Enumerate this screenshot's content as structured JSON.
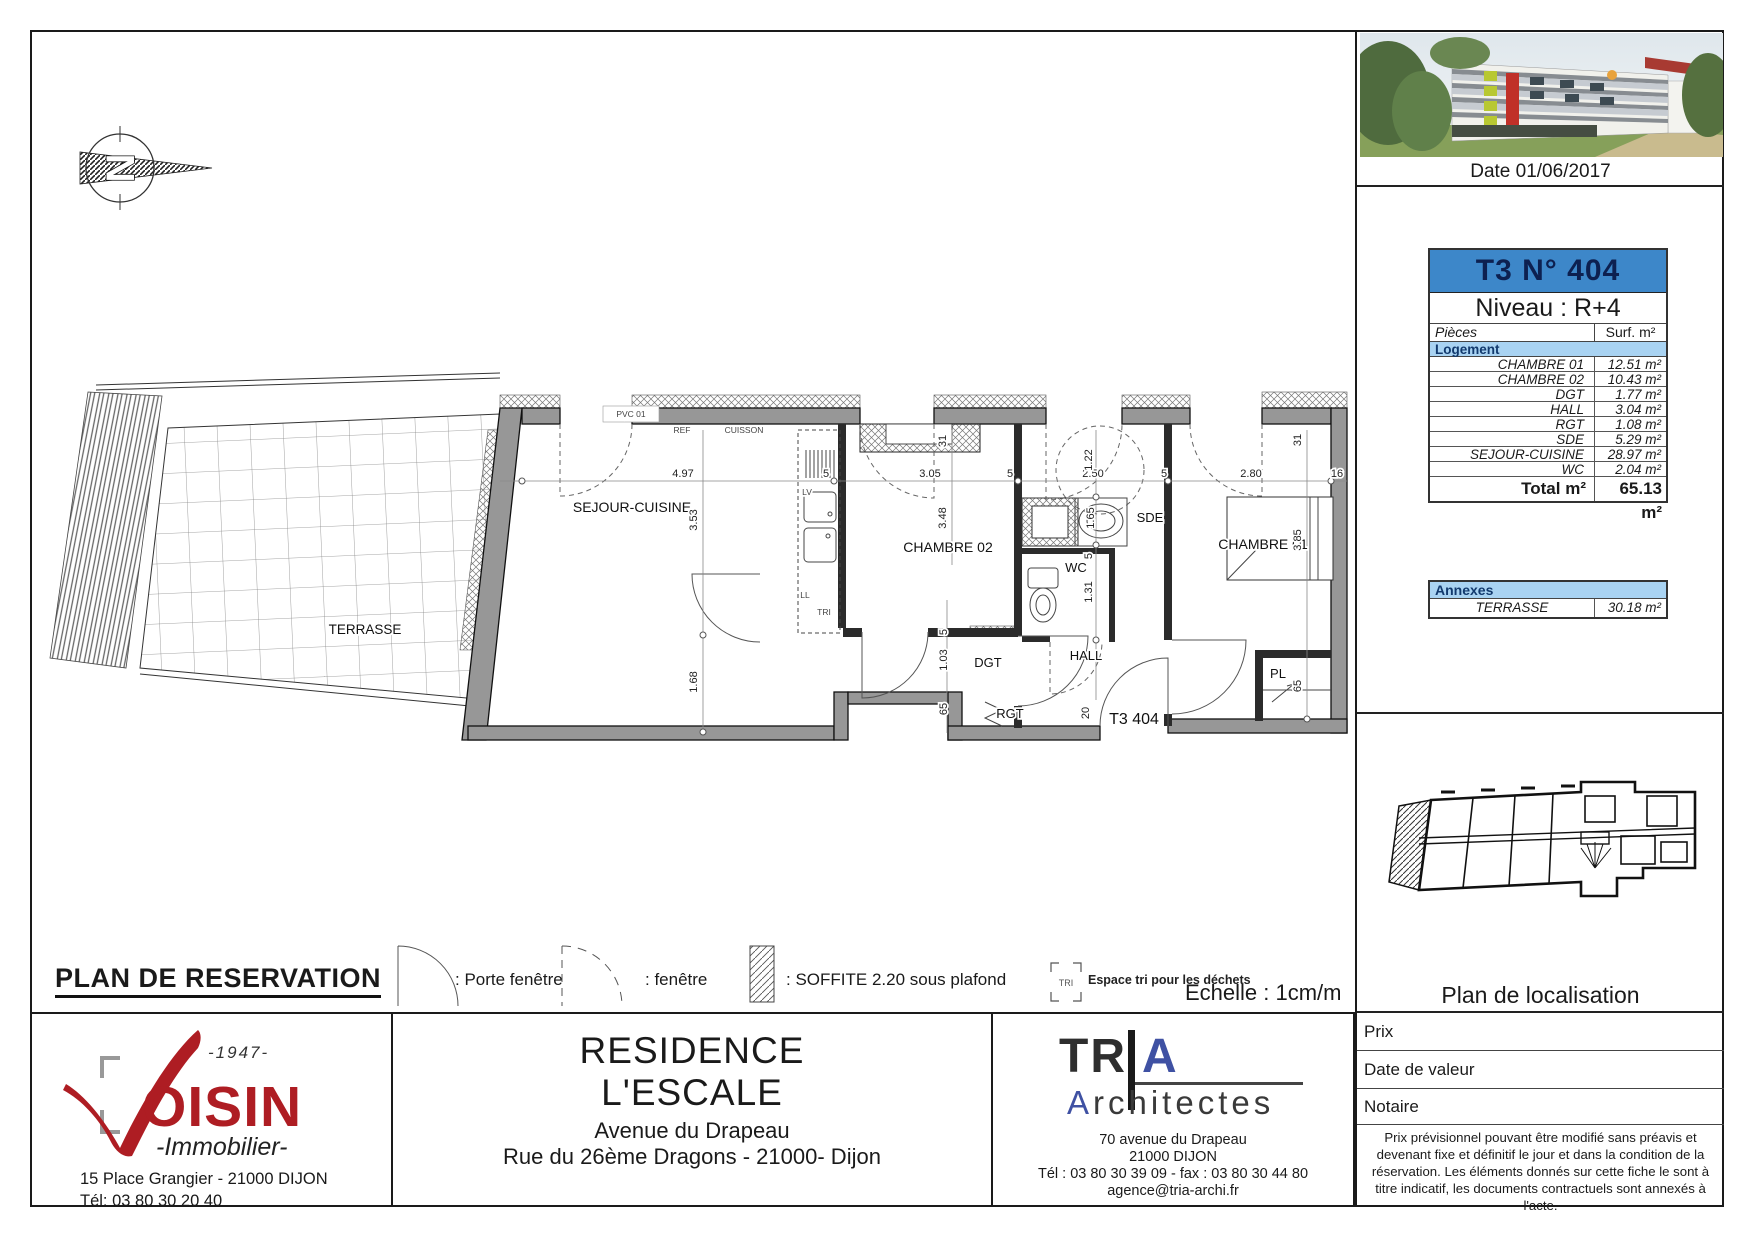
{
  "header": {
    "date": "Date 01/06/2017"
  },
  "unit_table": {
    "title": "T3 N° 404",
    "level": "Niveau : R+4",
    "col_pieces": "Pièces",
    "col_surface": "Surf. m²",
    "section": "Logement",
    "rows": [
      {
        "label": "CHAMBRE 01",
        "value": "12.51 m²"
      },
      {
        "label": "CHAMBRE 02",
        "value": "10.43 m²"
      },
      {
        "label": "DGT",
        "value": "1.77 m²"
      },
      {
        "label": "HALL",
        "value": "3.04 m²"
      },
      {
        "label": "RGT",
        "value": "1.08 m²"
      },
      {
        "label": "SDE",
        "value": "5.29 m²"
      },
      {
        "label": "SEJOUR-CUISINE",
        "value": "28.97 m²"
      },
      {
        "label": "WC",
        "value": "2.04 m²"
      }
    ],
    "total_label": "Total m²",
    "total_value": "65.13 m²"
  },
  "annexes_table": {
    "title": "Annexes",
    "rows": [
      {
        "label": "TERRASSE",
        "value": "30.18 m²"
      }
    ]
  },
  "localisation": {
    "title": "Plan de localisation"
  },
  "info_rows": [
    {
      "label": "Prix"
    },
    {
      "label": "Date de valeur"
    },
    {
      "label": "Notaire"
    }
  ],
  "disclaimer": "Prix prévisionnel pouvant être modifié sans préavis et devenant fixe et définitif le jour et dans la condition de la réservation. Les éléments donnés sur cette fiche le sont à titre indicatif, les documents contractuels sont annexés à l'acte.",
  "plan_title": "PLAN DE RESERVATION",
  "scale_label": "Echelle : 1cm/m",
  "legend": {
    "porte_fenetre": ": Porte fenêtre",
    "fenetre": ": fenêtre",
    "soffite": ": SOFFITE 2.20 sous plafond",
    "tri_symbol": "TRI",
    "tri_label": "Espace tri pour les déchets"
  },
  "voisin": {
    "year": "-1947-",
    "name": "OISIN",
    "subtitle": "-Immobilier-",
    "address": "15 Place Grangier - 21000 DIJON",
    "phone": "Tél: 03 80 30 20 40"
  },
  "residence": {
    "line1": "RESIDENCE",
    "line2": "L'ESCALE",
    "line3": "Avenue du Drapeau",
    "line4": "Rue du 26ème Dragons - 21000- Dijon"
  },
  "tria": {
    "logo_tr": "TR",
    "logo_a": "A",
    "sub_a": "A",
    "sub_rest": "rchitectes",
    "address1": "70 avenue du Drapeau",
    "address2": "21000 DIJON",
    "phone": "Tél : 03 80 30 39 09 - fax : 03 80 30 44 80",
    "email": "agence@tria-archi.fr"
  },
  "north_letter": "N",
  "floorplan": {
    "rooms": [
      {
        "t": "TERRASSE",
        "x": 365,
        "y": 634,
        "s": 13.5
      },
      {
        "t": "SEJOUR-CUISINE",
        "x": 632,
        "y": 512,
        "s": 14
      },
      {
        "t": "CHAMBRE 02",
        "x": 948,
        "y": 552,
        "s": 14
      },
      {
        "t": "CHAMBRE 01",
        "x": 1263,
        "y": 549,
        "s": 14
      },
      {
        "t": "SDE",
        "x": 1150,
        "y": 522,
        "s": 13
      },
      {
        "t": "WC",
        "x": 1076,
        "y": 572,
        "s": 13
      },
      {
        "t": "HALL",
        "x": 1086,
        "y": 660,
        "s": 13
      },
      {
        "t": "DGT",
        "x": 988,
        "y": 667,
        "s": 13
      },
      {
        "t": "RGT",
        "x": 1010,
        "y": 718,
        "s": 13
      },
      {
        "t": "PL",
        "x": 1278,
        "y": 678,
        "s": 13
      },
      {
        "t": "T3 404",
        "x": 1134,
        "y": 724,
        "s": 16
      }
    ],
    "dims_h": [
      {
        "t": "4.97",
        "x": 683,
        "y": 477
      },
      {
        "t": "5",
        "x": 826,
        "y": 477
      },
      {
        "t": "3.05",
        "x": 930,
        "y": 477
      },
      {
        "t": "5",
        "x": 1010,
        "y": 477
      },
      {
        "t": "2.50",
        "x": 1093,
        "y": 477
      },
      {
        "t": "5",
        "x": 1164,
        "y": 477
      },
      {
        "t": "2.80",
        "x": 1251,
        "y": 477
      },
      {
        "t": "16",
        "x": 1337,
        "y": 477
      }
    ],
    "dims_v": [
      {
        "t": "3.53",
        "x": 697,
        "y": 520
      },
      {
        "t": "1.68",
        "x": 697,
        "y": 682
      },
      {
        "t": "3.48",
        "x": 946,
        "y": 518
      },
      {
        "t": "31",
        "x": 946,
        "y": 441
      },
      {
        "t": "1.22",
        "x": 1092,
        "y": 460
      },
      {
        "t": "1.65",
        "x": 1094,
        "y": 518
      },
      {
        "t": "1.31",
        "x": 1092,
        "y": 592
      },
      {
        "t": "5",
        "x": 1092,
        "y": 556
      },
      {
        "t": "3.85",
        "x": 1301,
        "y": 540
      },
      {
        "t": "31",
        "x": 1301,
        "y": 440
      },
      {
        "t": "65",
        "x": 1301,
        "y": 686
      },
      {
        "t": "1.03",
        "x": 947,
        "y": 660
      },
      {
        "t": "65",
        "x": 947,
        "y": 709
      },
      {
        "t": "5",
        "x": 947,
        "y": 632
      },
      {
        "t": "20",
        "x": 1089,
        "y": 713
      }
    ],
    "small": [
      {
        "t": "PVC 01",
        "x": 631,
        "y": 417
      },
      {
        "t": "REF",
        "x": 682,
        "y": 433
      },
      {
        "t": "CUISSON",
        "x": 744,
        "y": 433
      },
      {
        "t": "LV",
        "x": 807,
        "y": 495
      },
      {
        "t": "LL",
        "x": 805,
        "y": 598
      },
      {
        "t": "TRI",
        "x": 824,
        "y": 615
      }
    ]
  },
  "colors": {
    "header_blue": "#3d87c9",
    "light_blue": "#a9d3f2",
    "voisin_red": "#ae1d23",
    "tria_blue": "#3f51a3"
  }
}
